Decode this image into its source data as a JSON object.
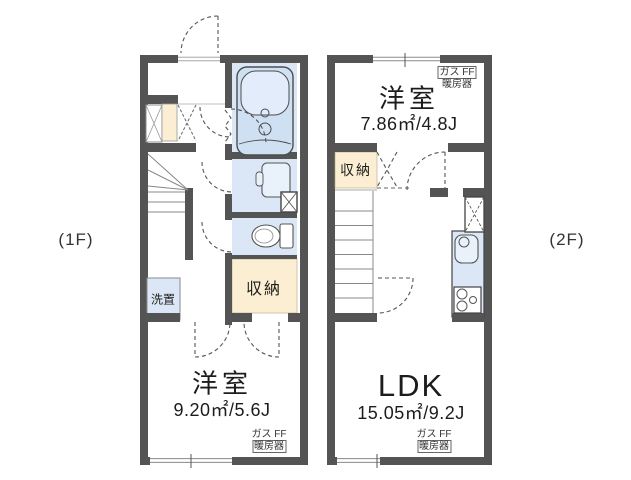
{
  "floor1": {
    "tag": "(1F)",
    "bedroom": {
      "name": "洋室",
      "size": "9.20㎡/5.6J"
    },
    "storage": "収納",
    "laundry": "洗置",
    "heater": {
      "line1": "ガス FF",
      "line2": "暖房器"
    }
  },
  "floor2": {
    "tag": "(2F)",
    "bedroom": {
      "name": "洋室",
      "size": "7.86㎡/4.8J"
    },
    "storage": "収納",
    "ldk": {
      "name": "LDK",
      "size": "15.05㎡/9.2J"
    },
    "heater": {
      "line1": "ガス FF",
      "line2": "暖房器"
    }
  },
  "colors": {
    "wall": "#545454",
    "wet_area": "#dbe7f6",
    "fixture_fill": "#e9f1fb",
    "storage_fill": "#fbeed3",
    "line": "#666666"
  }
}
